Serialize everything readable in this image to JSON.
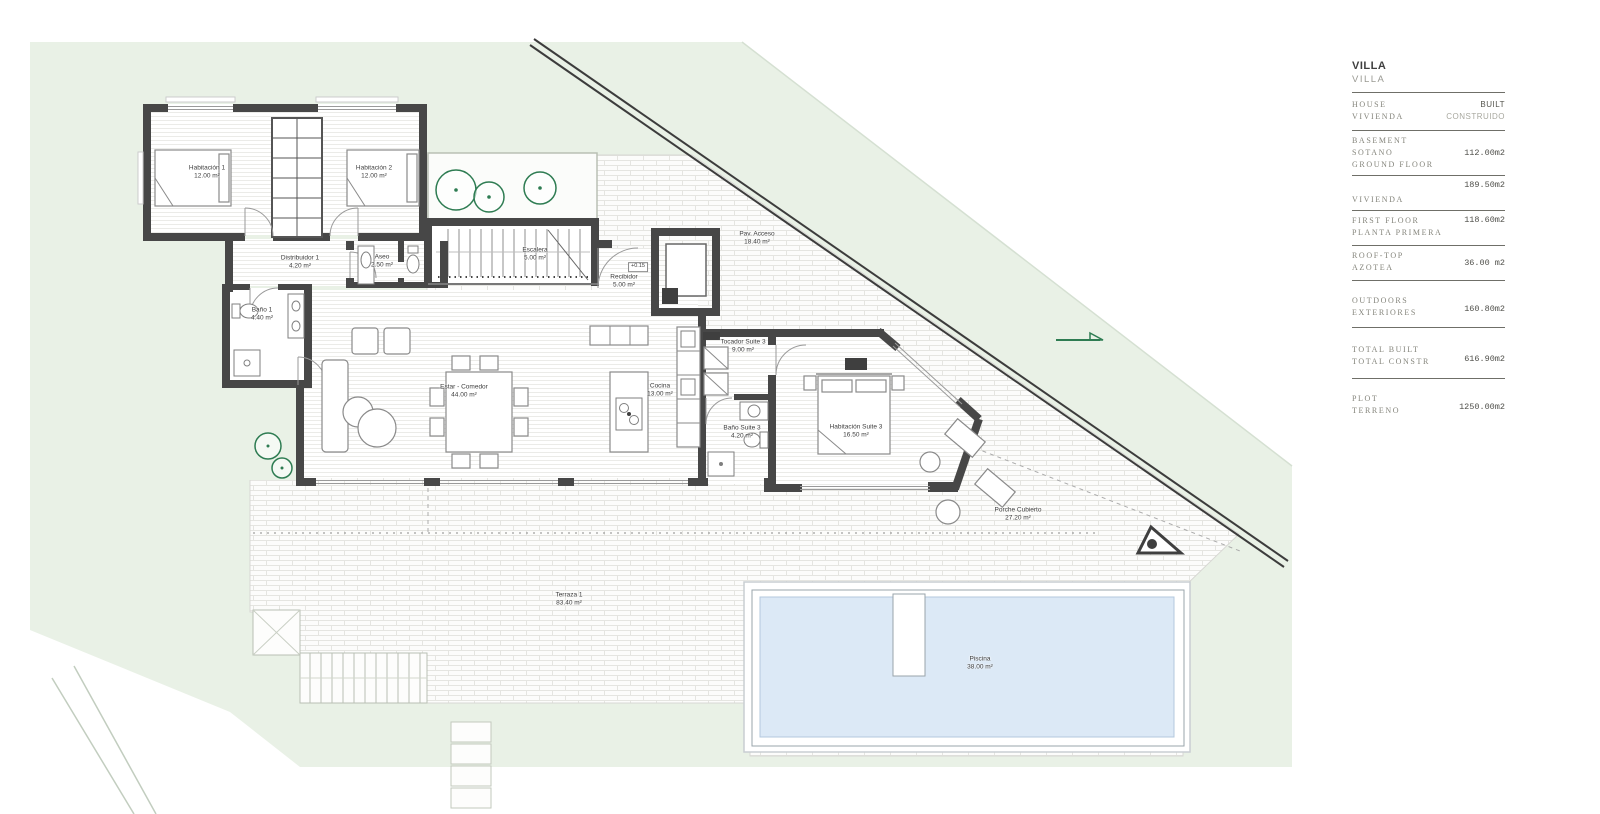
{
  "panel": {
    "title": "VILLA",
    "subtitle": "VILLA",
    "header": {
      "left_lines": [
        "HOUSE",
        "VIVIENDA"
      ],
      "right_lines": [
        "BUILT",
        "CONSTRUIDO"
      ]
    },
    "rows": [
      {
        "label_lines": [
          "BASEMENT",
          "SOTANO",
          "GROUND FLOOR"
        ],
        "value": "112.00m2",
        "value_align": "middle"
      },
      {
        "label_lines": [
          "VIVIENDA"
        ],
        "value": "189.50m2",
        "value_align": "above"
      },
      {
        "label_lines": [
          "FIRST FLOOR",
          "PLANTA PRIMERA"
        ],
        "value": "118.60m2",
        "value_align": "top"
      },
      {
        "label_lines": [
          "ROOF-TOP",
          "AZOTEA"
        ],
        "value": "36.00 m2",
        "value_align": "middle"
      },
      {
        "label_lines": [
          "OUTDOORS",
          "EXTERIORES"
        ],
        "value": "160.80m2",
        "value_align": "middle"
      },
      {
        "label_lines": [
          "TOTAL BUILT",
          "TOTAL CONSTR"
        ],
        "value": "616.90m2",
        "value_align": "middle"
      },
      {
        "label_lines": [
          "PLOT",
          "TERRENO"
        ],
        "value": "1250.00m2",
        "value_align": "middle"
      }
    ]
  },
  "plan": {
    "level_marker": "+0.15",
    "rooms": [
      {
        "name": "Habitación 1",
        "area": "12.00 m²",
        "x": 207,
        "y": 173
      },
      {
        "name": "Habitación 2",
        "area": "12.00 m²",
        "x": 374,
        "y": 173
      },
      {
        "name": "Distribuidor 1",
        "area": "4.20 m²",
        "x": 300,
        "y": 263
      },
      {
        "name": "Aseo",
        "area": "2.50 m²",
        "x": 382,
        "y": 262
      },
      {
        "name": "Escalera",
        "area": "5.00 m²",
        "x": 535,
        "y": 255
      },
      {
        "name": "Recibidor",
        "area": "5.00 m²",
        "x": 624,
        "y": 282
      },
      {
        "name": "Pav. Acceso",
        "area": "18.40 m²",
        "x": 757,
        "y": 239
      },
      {
        "name": "Baño 1",
        "area": "4.40 m²",
        "x": 262,
        "y": 315
      },
      {
        "name": "Estar - Comedor",
        "area": "44.00 m²",
        "x": 464,
        "y": 392
      },
      {
        "name": "Cocina",
        "area": "13.00 m²",
        "x": 660,
        "y": 391
      },
      {
        "name": "Tocador Suite 3",
        "area": "9.00 m²",
        "x": 743,
        "y": 347
      },
      {
        "name": "Baño Suite 3",
        "area": "4.20 m²",
        "x": 742,
        "y": 433
      },
      {
        "name": "Habitación Suite 3",
        "area": "16.50 m²",
        "x": 856,
        "y": 432
      },
      {
        "name": "Porche Cubierto",
        "area": "27.20 m²",
        "x": 1018,
        "y": 515
      },
      {
        "name": "Terraza 1",
        "area": "83.40 m²",
        "x": 569,
        "y": 600
      },
      {
        "name": "Piscina",
        "area": "38.00 m²",
        "x": 980,
        "y": 664
      }
    ]
  },
  "colors": {
    "site_green": "#e9f1e6",
    "wall_gray": "#474747",
    "tree_green": "#2e7c52",
    "pool_water": "#dce9f6",
    "road_gray": "#3c3c3c",
    "panel_text": "#85857c"
  }
}
